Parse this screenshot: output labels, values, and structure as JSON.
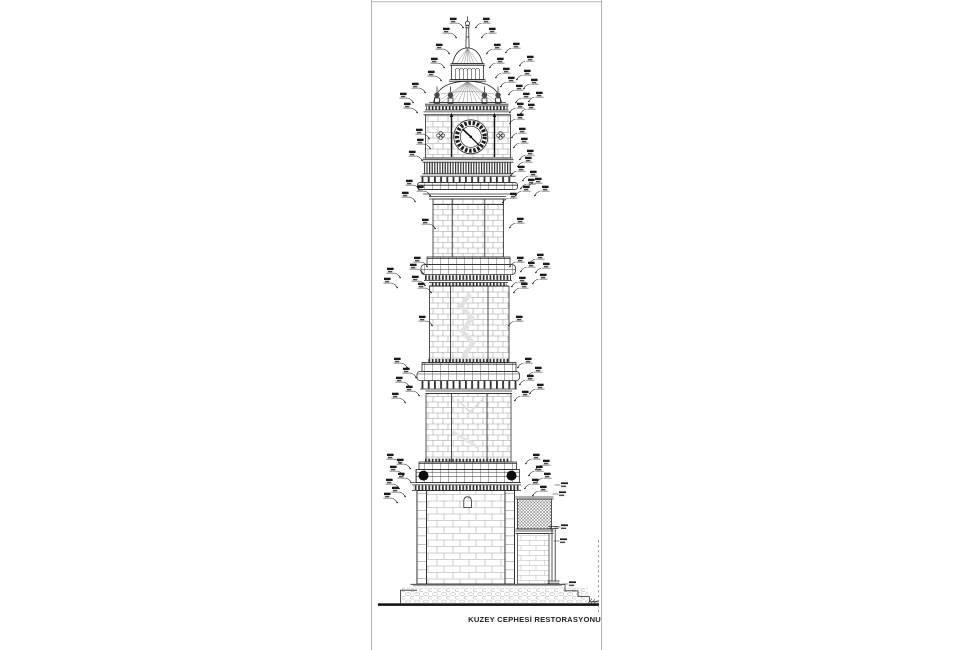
{
  "sheet": {
    "title": "KUZEY CEPHESİ RESTORASYONU"
  },
  "colors": {
    "ink": "#2b2b2b",
    "dark": "#141414",
    "masonry": "#9a9a9a",
    "faint": "#e0e0e0",
    "border": "#b3b3b3",
    "ball": "#0d0d0d",
    "ground": "#151515",
    "annotation": "#1a1a1a"
  },
  "annotations": {
    "mark_color": "#1a1a1a",
    "left": [
      [
        450,
        22
      ],
      [
        443,
        32
      ],
      [
        436,
        48
      ],
      [
        431,
        62
      ],
      [
        428,
        75
      ],
      [
        412,
        87
      ],
      [
        400,
        97
      ],
      [
        404,
        107
      ],
      [
        416,
        133
      ],
      [
        417,
        143
      ],
      [
        409,
        155
      ],
      [
        406,
        184
      ],
      [
        417,
        190
      ],
      [
        402,
        196
      ],
      [
        422,
        223
      ],
      [
        414,
        261
      ],
      [
        410,
        268
      ],
      [
        387,
        272
      ],
      [
        412,
        280
      ],
      [
        384,
        282
      ],
      [
        418,
        287
      ],
      [
        419,
        320
      ],
      [
        394,
        362
      ],
      [
        403,
        372
      ],
      [
        396,
        381
      ],
      [
        406,
        390
      ],
      [
        392,
        397
      ],
      [
        387,
        458
      ],
      [
        397,
        463
      ],
      [
        390,
        470
      ],
      [
        398,
        477
      ],
      [
        386,
        483
      ],
      [
        392,
        491
      ],
      [
        384,
        497
      ]
    ],
    "right": [
      [
        483,
        22
      ],
      [
        489,
        32
      ],
      [
        494,
        48
      ],
      [
        513,
        47
      ],
      [
        497,
        62
      ],
      [
        527,
        60
      ],
      [
        503,
        72
      ],
      [
        524,
        74
      ],
      [
        508,
        81
      ],
      [
        531,
        83
      ],
      [
        516,
        89
      ],
      [
        523,
        97
      ],
      [
        536,
        96
      ],
      [
        517,
        107
      ],
      [
        528,
        108
      ],
      [
        517,
        118
      ],
      [
        519,
        132
      ],
      [
        521,
        142
      ],
      [
        527,
        154
      ],
      [
        525,
        161
      ],
      [
        518,
        170
      ],
      [
        530,
        175
      ],
      [
        528,
        183
      ],
      [
        523,
        190
      ],
      [
        510,
        197
      ],
      [
        535,
        182
      ],
      [
        542,
        190
      ],
      [
        517,
        222
      ],
      [
        537,
        258
      ],
      [
        543,
        267
      ],
      [
        517,
        261
      ],
      [
        528,
        266
      ],
      [
        540,
        278
      ],
      [
        519,
        281
      ],
      [
        521,
        287
      ],
      [
        516,
        320
      ],
      [
        525,
        362
      ],
      [
        535,
        371
      ],
      [
        527,
        379
      ],
      [
        537,
        388
      ],
      [
        522,
        395
      ],
      [
        533,
        458
      ],
      [
        543,
        464
      ],
      [
        536,
        470
      ],
      [
        544,
        477
      ],
      [
        532,
        483
      ],
      [
        540,
        490
      ]
    ],
    "side_labels": [
      [
        561,
        485
      ],
      [
        559,
        494
      ],
      [
        561,
        527
      ],
      [
        560,
        541
      ],
      [
        569,
        584
      ]
    ]
  }
}
